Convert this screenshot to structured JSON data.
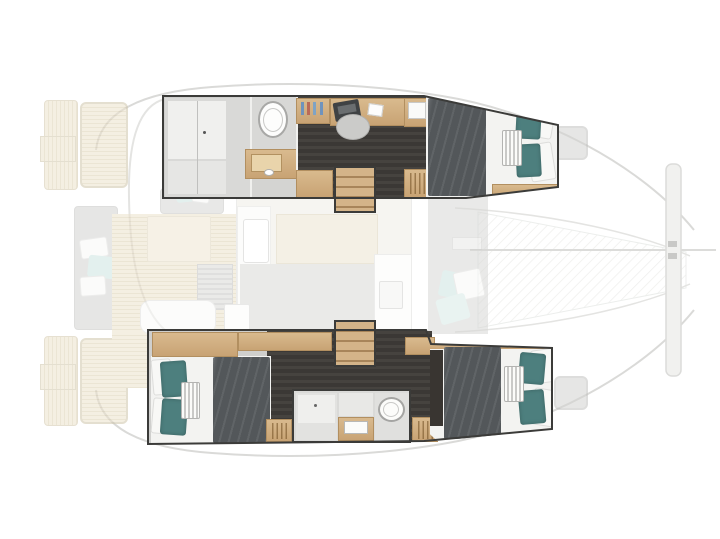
{
  "title": "Catamaran yacht layout floor plan (top view)",
  "visible_text": [],
  "colors": {
    "wood": "#d9ba8e",
    "wood_dark": "#c8a374",
    "dark_floor": "#3b3835",
    "blanket": "#53575a",
    "teal_pillow": "#4d7f7e",
    "mattress": "#f3f3f1",
    "teak": "#ece2cc",
    "teak_line": "#dcd0b2",
    "hull_border": "#3b3b39",
    "wall_gray": "#d8d8d6",
    "faded_gray": "#d5d5d3",
    "accent_teal_light": "#cde5e1",
    "outline_gray": "#d9d9d7",
    "white": "#ffffff"
  },
  "boat": {
    "type": "sailing catamaran",
    "orientation": "bow right, stern left",
    "highlighted_areas": [
      "port hull interior (top)",
      "starboard hull interior (bottom)"
    ],
    "port_hull": {
      "rooms": [
        {
          "name": "shower room",
          "items": [
            "shower floor",
            "glass divider",
            "drain"
          ]
        },
        {
          "name": "toilet nook",
          "items": [
            "toilet"
          ]
        },
        {
          "name": "vanity",
          "items": [
            "wood counter",
            "sink basin"
          ]
        },
        {
          "name": "office area",
          "items": [
            "shelf with bottles",
            "desk",
            "laptop",
            "book",
            "chair",
            "nightstand"
          ]
        },
        {
          "name": "companionway steps"
        },
        {
          "name": "forward berth",
          "items": [
            "double bed",
            "dark blanket",
            "striped bolster",
            "2 teal pillows",
            "2 white pillows"
          ]
        }
      ]
    },
    "starboard_hull": {
      "rooms": [
        {
          "name": "aft berth",
          "items": [
            "double bed",
            "dark blanket",
            "striped bolster",
            "2 teal pillows",
            "2 white pillows",
            "wardrobe strip"
          ]
        },
        {
          "name": "companionway steps"
        },
        {
          "name": "bathroom",
          "items": [
            "shower",
            "sink counter",
            "toilet"
          ]
        },
        {
          "name": "forward berth",
          "items": [
            "double bed",
            "dark blanket",
            "striped bolster",
            "2 teal pillows",
            "2 white pillows",
            "dark wardrobe"
          ]
        }
      ]
    },
    "deck_faded": [
      "port swim platform and transom steps",
      "starboard swim platform and transom steps",
      "boarding ladders",
      "aft bench with white and teal pillows",
      "cockpit teak deck",
      "cockpit table",
      "cockpit sofa with pillows",
      "louvered locker",
      "salon with galley counter and sink",
      "salon island table",
      "chart cabinet with hatch",
      "foredeck lounge with pillows",
      "trampoline",
      "forward crossbeam and bridle line",
      "port deck hatch",
      "starboard deck hatch"
    ]
  }
}
